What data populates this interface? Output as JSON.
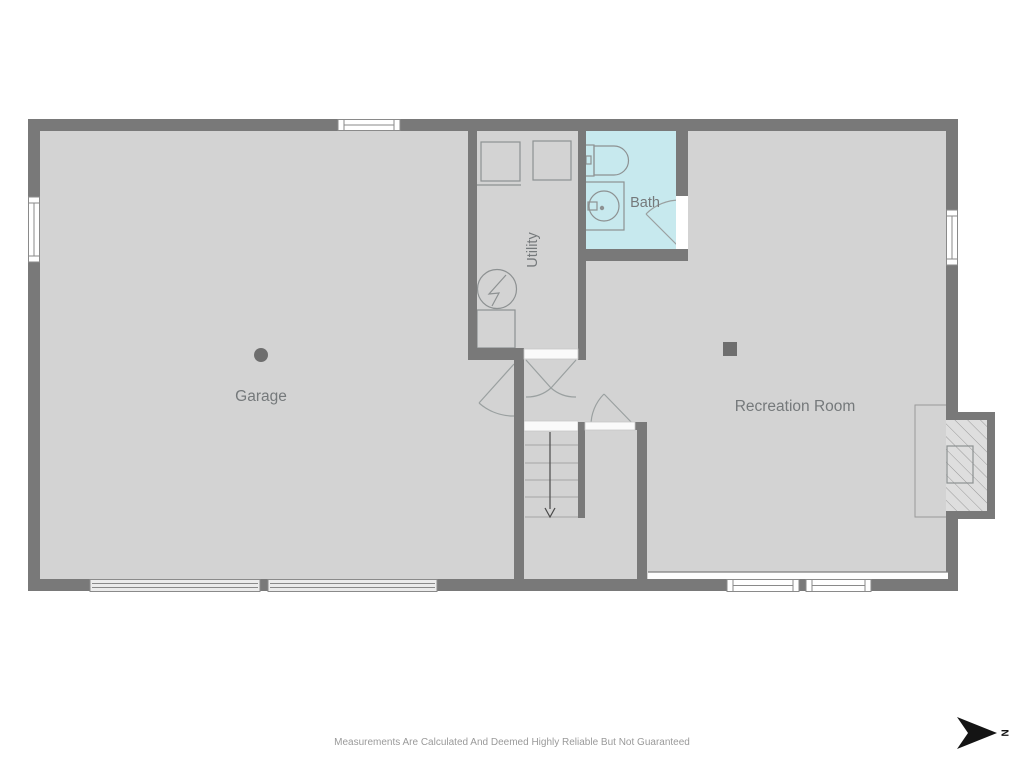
{
  "colors": {
    "wall": "#797979",
    "floor": "#d3d3d3",
    "bath_floor": "#c7e9ee",
    "fixture_line": "#8d9192",
    "door_line": "#9aa0a0",
    "stair_line": "#a6a6a6",
    "window_frame": "#8a8a8a",
    "label": "#75797b",
    "disclaimer": "#9a9a9a",
    "north": "#141414"
  },
  "rooms": [
    {
      "id": "garage",
      "label": "Garage"
    },
    {
      "id": "utility",
      "label": "Utility"
    },
    {
      "id": "bath",
      "label": "Bath"
    },
    {
      "id": "recreation",
      "label": "Recreation Room"
    }
  ],
  "fixtures": {
    "washer": "washer-unit",
    "dryer": "dryer-unit",
    "electrical_panel": "electrical-panel",
    "laundry_tub": "laundry-tub",
    "toilet": "toilet",
    "sink": "sink-vanity",
    "floor_drain": "floor-drain",
    "support_post": "support-post",
    "fireplace": "fireplace-hearth",
    "stairs": "stairs-down",
    "garage_doors": "garage-doors"
  },
  "compass": {
    "label": "N",
    "direction": "right"
  },
  "footer": {
    "disclaimer": "Measurements Are Calculated And Deemed Highly Reliable But Not Guaranteed"
  }
}
